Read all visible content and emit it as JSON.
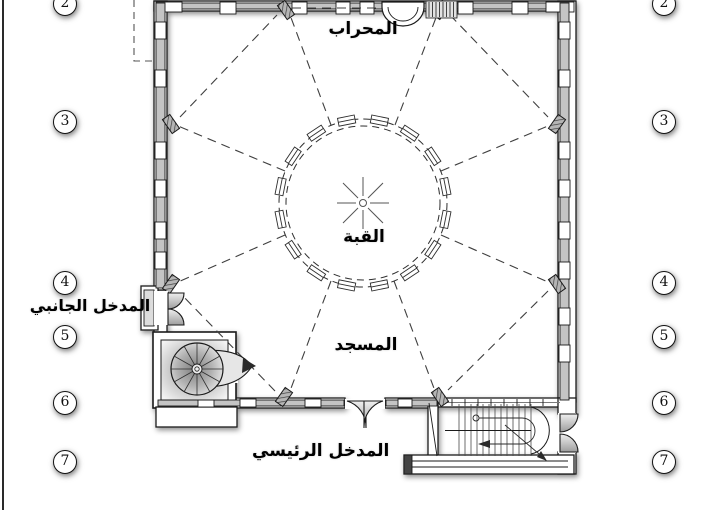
{
  "labels": {
    "mihrab": "المحراب",
    "dome": "القبة",
    "mosque": "المسجد",
    "side_entrance": "المدخل الجانبي",
    "main_entrance": "المدخل الرئيسي"
  },
  "grid": {
    "left": [
      "2",
      "3",
      "4",
      "5",
      "6",
      "7"
    ],
    "right": [
      "2",
      "3",
      "4",
      "5",
      "6",
      "7"
    ]
  },
  "colors": {
    "line": "#1a1a1a",
    "dashed_line": "#3f3f3f",
    "wall_band": "#c4c4c4",
    "hatch_fill": "#b5b5b5",
    "shadow": "rgba(0,0,0,0.45)",
    "background": "#ffffff"
  }
}
